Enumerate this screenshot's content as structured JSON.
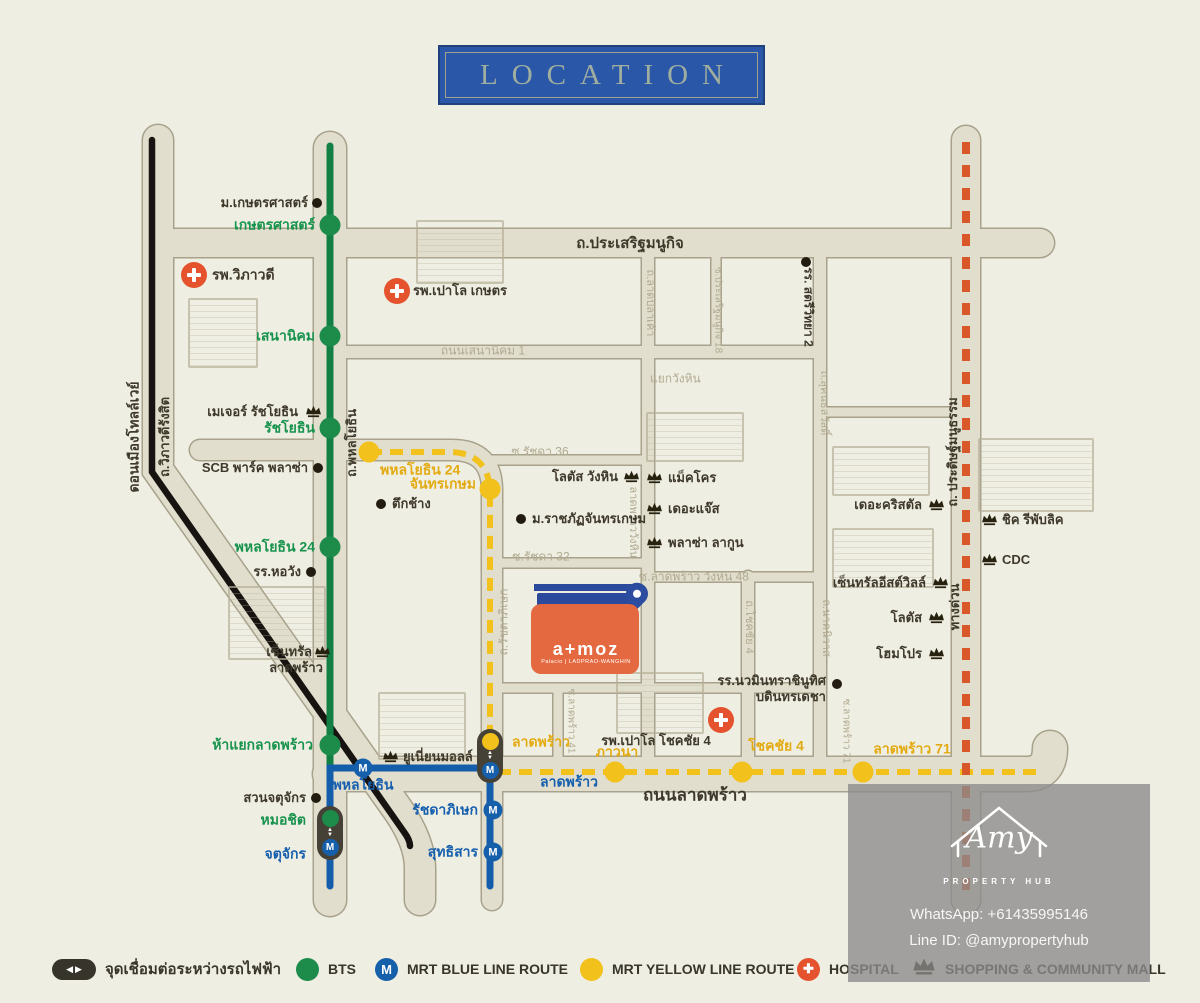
{
  "title": "LOCATION",
  "legend": {
    "items": [
      {
        "icon": "interchange-pill",
        "label": "จุดเชื่อมต่อระหว่างรถไฟฟ้า"
      },
      {
        "icon": "bts-circle",
        "label": "BTS"
      },
      {
        "icon": "mrt-blue-circle",
        "label": "MRT BLUE LINE ROUTE"
      },
      {
        "icon": "mrt-yellow-circle",
        "label": "MRT YELLOW LINE ROUTE"
      },
      {
        "icon": "hospital-cross",
        "label": "HOSPITAL"
      },
      {
        "icon": "crown",
        "label": "SHOPPING & COMMUNITY MALL"
      }
    ]
  },
  "watermark": {
    "brand": "Amy",
    "tagline": "PROPERTY HUB",
    "whatsapp": "WhatsApp: +61435995146",
    "line_id": "Line ID: @amypropertyhub"
  },
  "atmoz": {
    "brand": "a+moz",
    "sub": "Palacio | LADPRAO-WANGHIN"
  },
  "map": {
    "colors": {
      "background": "#efeee2",
      "road_fill": "#e1decd",
      "road_casing": "#a8a28c",
      "bts_green": "#1d8c4b",
      "mrt_blue": "#155fab",
      "mrt_yellow": "#f2c11b",
      "expressway_orange": "#d8582a",
      "tollway_black": "#171310",
      "hospital_red": "#e4532e",
      "title_blue": "#2b57a9"
    },
    "labels": [
      {
        "t": "ถ.ประเสริฐมนูกิจ",
        "x": 630,
        "y": 244,
        "a": "c",
        "s": 15
      },
      {
        "t": "ถนนลาดพร้าว",
        "x": 695,
        "y": 796,
        "a": "c",
        "s": 17
      },
      {
        "t": "ถนนเสนานิคม 1",
        "x": 483,
        "y": 351,
        "a": "c",
        "c": "be",
        "s": 12
      },
      {
        "t": "แยกวังหิน",
        "x": 650,
        "y": 379,
        "a": "l",
        "c": "be",
        "s": 12
      },
      {
        "t": "ซ.รัชดา 36",
        "x": 540,
        "y": 452,
        "a": "c",
        "c": "be",
        "s": 12
      },
      {
        "t": "ซ.รัชดา 32",
        "x": 541,
        "y": 557,
        "a": "c",
        "c": "be",
        "s": 12
      },
      {
        "t": "ซ.ลาดพร้าว วังหิน 48",
        "x": 694,
        "y": 577,
        "a": "c",
        "c": "be",
        "s": 12
      },
      {
        "t": "ดอนเมืองโทลล์เวย์",
        "x": 134,
        "y": 437,
        "a": "c",
        "r": -90,
        "s": 14
      },
      {
        "t": "ถ.วิภาวดีรังสิต",
        "x": 165,
        "y": 437,
        "a": "c",
        "r": -90,
        "s": 13
      },
      {
        "t": "ถ.พหลโยธิน",
        "x": 352,
        "y": 443,
        "a": "c",
        "r": -90,
        "s": 13
      },
      {
        "t": "ถ.ลาดปลาเค้า",
        "x": 650,
        "y": 303,
        "a": "c",
        "r": 90,
        "c": "be",
        "s": 11
      },
      {
        "t": "ซ.ประเสริฐมนูกิจ 18",
        "x": 718,
        "y": 310,
        "a": "c",
        "r": 90,
        "c": "be",
        "s": 10
      },
      {
        "t": "ถ.รัชดาภิเษก",
        "x": 504,
        "y": 622,
        "a": "c",
        "r": -90,
        "c": "be",
        "s": 12
      },
      {
        "t": "ถ. ลาดพร้าววังหิน",
        "x": 633,
        "y": 516,
        "a": "c",
        "r": 90,
        "c": "be",
        "s": 11
      },
      {
        "t": "ถ.โชคชัย 4",
        "x": 749,
        "y": 627,
        "a": "c",
        "r": 90,
        "c": "be",
        "s": 11
      },
      {
        "t": "ถ.นาคนิวาส",
        "x": 826,
        "y": 628,
        "a": "c",
        "r": 90,
        "c": "be",
        "s": 11
      },
      {
        "t": "ถ.สุคนธสวัสดิ์",
        "x": 824,
        "y": 403,
        "a": "c",
        "r": 90,
        "c": "be",
        "s": 11
      },
      {
        "t": "ซ.ลาดพร้าว 41",
        "x": 571,
        "y": 721,
        "a": "c",
        "r": 90,
        "c": "be",
        "s": 10
      },
      {
        "t": "ซ.ลาดพร้าว 71",
        "x": 846,
        "y": 731,
        "a": "c",
        "r": 90,
        "c": "be",
        "s": 10
      },
      {
        "t": "ถ. ประดิษฐ์มนูธรรม",
        "x": 953,
        "y": 452,
        "a": "c",
        "r": -90,
        "s": 13
      },
      {
        "t": "ทางด่วน",
        "x": 955,
        "y": 607,
        "a": "c",
        "r": -90,
        "s": 13
      },
      {
        "t": "เกษตรศาสตร์",
        "x": 315,
        "y": 225,
        "a": "r",
        "c": "g",
        "s": 14
      },
      {
        "t": "เสนานิคม",
        "x": 315,
        "y": 336,
        "a": "r",
        "c": "g",
        "s": 14
      },
      {
        "t": "รัชโยธิน",
        "x": 315,
        "y": 428,
        "a": "r",
        "c": "g",
        "s": 14
      },
      {
        "t": "พหลโยธิน 24",
        "x": 315,
        "y": 547,
        "a": "r",
        "c": "g",
        "s": 14
      },
      {
        "t": "ห้าแยกลาดพร้าว",
        "x": 313,
        "y": 745,
        "a": "r",
        "c": "g",
        "s": 14
      },
      {
        "t": "หมอชิต",
        "x": 306,
        "y": 820,
        "a": "r",
        "c": "g",
        "s": 14
      },
      {
        "t": "จตุจักร",
        "x": 306,
        "y": 854,
        "a": "r",
        "c": "bl",
        "s": 14
      },
      {
        "t": "พหลโยธิน",
        "x": 363,
        "y": 785,
        "a": "c",
        "c": "bl",
        "s": 14
      },
      {
        "t": "ลาดพร้าว",
        "x": 540,
        "y": 782,
        "a": "l",
        "c": "bl",
        "s": 14
      },
      {
        "t": "รัชดาภิเษก",
        "x": 478,
        "y": 810,
        "a": "r",
        "c": "bl",
        "s": 14
      },
      {
        "t": "สุทธิสาร",
        "x": 478,
        "y": 852,
        "a": "r",
        "c": "bl",
        "s": 14
      },
      {
        "t": "พหลโยธิน 24",
        "x": 380,
        "y": 470,
        "a": "l",
        "c": "y",
        "s": 14
      },
      {
        "t": "จันทรเกษม",
        "x": 476,
        "y": 484,
        "a": "r",
        "c": "y",
        "s": 14
      },
      {
        "t": "ลาดพร้าว",
        "x": 512,
        "y": 742,
        "a": "l",
        "c": "y",
        "s": 14
      },
      {
        "t": "ภาวนา",
        "x": 617,
        "y": 752,
        "a": "c",
        "c": "y",
        "s": 14
      },
      {
        "t": "โชคชัย 4",
        "x": 776,
        "y": 746,
        "a": "c",
        "c": "y",
        "s": 14
      },
      {
        "t": "ลาดพร้าว 71",
        "x": 912,
        "y": 749,
        "a": "c",
        "c": "y",
        "s": 14
      },
      {
        "t": "ม.เกษตรศาสตร์",
        "x": 308,
        "y": 203,
        "a": "r"
      },
      {
        "t": "รพ.วิภาวดี",
        "x": 212,
        "y": 275,
        "a": "l",
        "s": 14
      },
      {
        "t": "SCB พาร์ค พลาซ่า",
        "x": 308,
        "y": 468,
        "a": "r"
      },
      {
        "t": "ตึกช้าง",
        "x": 392,
        "y": 504,
        "a": "l"
      },
      {
        "t": "รร.หอวัง",
        "x": 301,
        "y": 572,
        "a": "r"
      },
      {
        "t": "เมเจอร์ รัชโยธิน",
        "x": 298,
        "y": 412,
        "a": "r"
      },
      {
        "t": "สวนจตุจักร",
        "x": 306,
        "y": 798,
        "a": "r"
      },
      {
        "t": "เซ็นทรัล",
        "x": 312,
        "y": 652,
        "a": "r"
      },
      {
        "t": "ลาดพร้าว",
        "x": 296,
        "y": 668,
        "a": "c"
      },
      {
        "t": "ยูเนี่ยนมอลล์",
        "x": 403,
        "y": 757,
        "a": "l"
      },
      {
        "t": "โลตัส วังหิน",
        "x": 618,
        "y": 477,
        "a": "r"
      },
      {
        "t": "แม็คโคร",
        "x": 668,
        "y": 478,
        "a": "l"
      },
      {
        "t": "เดอะแจ๊ส",
        "x": 668,
        "y": 509,
        "a": "l"
      },
      {
        "t": "พลาซ่า ลากูน",
        "x": 668,
        "y": 543,
        "a": "l"
      },
      {
        "t": "ม.ราชภัฏจันทรเกษม",
        "x": 532,
        "y": 519,
        "a": "l"
      },
      {
        "t": "รพ.เปาโล เกษตร",
        "x": 413,
        "y": 291,
        "a": "l"
      },
      {
        "t": "รพ.เปาโล โชคชัย 4",
        "x": 656,
        "y": 741,
        "a": "c"
      },
      {
        "t": "รร.นวมินทราชินูทิศ",
        "x": 826,
        "y": 681,
        "a": "r"
      },
      {
        "t": "บดินทรเดชา",
        "x": 826,
        "y": 697,
        "a": "r"
      },
      {
        "t": "รร. สตรีวิทยา 2",
        "x": 808,
        "y": 307,
        "a": "c",
        "r": 90,
        "s": 12
      },
      {
        "t": "เดอะคริสตัล",
        "x": 922,
        "y": 505,
        "a": "r"
      },
      {
        "t": "เซ็นทรัลอีสต์วิลล์",
        "x": 926,
        "y": 583,
        "a": "r"
      },
      {
        "t": "โลตัส",
        "x": 922,
        "y": 618,
        "a": "r"
      },
      {
        "t": "โฮมโปร",
        "x": 922,
        "y": 654,
        "a": "r"
      },
      {
        "t": "ชิค รีพับลิค",
        "x": 1002,
        "y": 520,
        "a": "l"
      },
      {
        "t": "CDC",
        "x": 1002,
        "y": 560,
        "a": "l"
      }
    ],
    "icons": [
      {
        "type": "bts",
        "name": "bts-station-kasetsart",
        "x": 330,
        "y": 225
      },
      {
        "type": "bts",
        "name": "bts-station-senanikhom",
        "x": 330,
        "y": 336
      },
      {
        "type": "bts",
        "name": "bts-station-ratchayothin",
        "x": 330,
        "y": 428
      },
      {
        "type": "bts",
        "name": "bts-station-phahonyothin24",
        "x": 330,
        "y": 547
      },
      {
        "type": "bts",
        "name": "bts-station-hayaeklatphrao",
        "x": 330,
        "y": 745
      },
      {
        "type": "yellow",
        "name": "mrt-yellow-station-phahonyothin24",
        "x": 369,
        "y": 452
      },
      {
        "type": "yellow",
        "name": "mrt-yellow-station-chankasem",
        "x": 490,
        "y": 489
      },
      {
        "type": "yellow",
        "name": "mrt-yellow-station-phawana",
        "x": 615,
        "y": 772
      },
      {
        "type": "yellow",
        "name": "mrt-yellow-station-chokchai4",
        "x": 742,
        "y": 772
      },
      {
        "type": "yellow",
        "name": "mrt-yellow-station-latphrao71",
        "x": 863,
        "y": 772
      },
      {
        "type": "mrt",
        "name": "mrt-station-phahonyothin",
        "x": 363,
        "y": 768
      },
      {
        "type": "mrt",
        "name": "mrt-station-ratchadaphisek",
        "x": 493,
        "y": 810
      },
      {
        "type": "mrt",
        "name": "mrt-station-sutthisan",
        "x": 493,
        "y": 852
      },
      {
        "type": "pill",
        "top": "bts",
        "name": "interchange-mochit-chatuchak",
        "x": 330,
        "y": 833
      },
      {
        "type": "pill",
        "top": "yellow",
        "name": "interchange-latphrao",
        "x": 490,
        "y": 756
      },
      {
        "type": "dot",
        "name": "poi-kasetsart-university",
        "x": 317,
        "y": 203
      },
      {
        "type": "dot",
        "name": "poi-scb-park-plaza",
        "x": 318,
        "y": 468
      },
      {
        "type": "dot",
        "name": "poi-elephant-tower",
        "x": 381,
        "y": 504
      },
      {
        "type": "dot",
        "name": "poi-horwang-school",
        "x": 311,
        "y": 572
      },
      {
        "type": "dot",
        "name": "poi-chatuchak-park",
        "x": 316,
        "y": 798
      },
      {
        "type": "dot",
        "name": "poi-chandrakasem-university",
        "x": 521,
        "y": 519
      },
      {
        "type": "dot",
        "name": "poi-bodindecha-school",
        "x": 837,
        "y": 684
      },
      {
        "type": "dot",
        "name": "poi-satriwitthaya2-school",
        "x": 806,
        "y": 262
      },
      {
        "type": "hospital",
        "name": "hospital-vibhavadi",
        "x": 194,
        "y": 275
      },
      {
        "type": "hospital",
        "name": "hospital-paolo-kaset",
        "x": 397,
        "y": 291
      },
      {
        "type": "hospital",
        "name": "hospital-paolo-chokchai4",
        "x": 721,
        "y": 720
      },
      {
        "type": "crown",
        "name": "mall-major-ratchayothin",
        "x": 313,
        "y": 411
      },
      {
        "type": "crown",
        "name": "mall-central-ladprao",
        "x": 322,
        "y": 651
      },
      {
        "type": "crown",
        "name": "mall-union-mall",
        "x": 390,
        "y": 756
      },
      {
        "type": "crown",
        "name": "mall-lotus-wanghin",
        "x": 631,
        "y": 476
      },
      {
        "type": "crown",
        "name": "mall-makro",
        "x": 654,
        "y": 477
      },
      {
        "type": "crown",
        "name": "mall-the-jas",
        "x": 654,
        "y": 508
      },
      {
        "type": "crown",
        "name": "mall-plaza-lagoon",
        "x": 654,
        "y": 542
      },
      {
        "type": "crown",
        "name": "mall-the-crystal",
        "x": 936,
        "y": 504
      },
      {
        "type": "crown",
        "name": "mall-central-eastville",
        "x": 940,
        "y": 582
      },
      {
        "type": "crown",
        "name": "mall-lotus",
        "x": 936,
        "y": 617
      },
      {
        "type": "crown",
        "name": "mall-homepro",
        "x": 936,
        "y": 653
      },
      {
        "type": "crown",
        "name": "mall-chic-republic",
        "x": 989,
        "y": 519
      },
      {
        "type": "crown",
        "name": "mall-cdc",
        "x": 989,
        "y": 559
      },
      {
        "type": "pin",
        "name": "atmoz-location-pin",
        "x": 637,
        "y": 603
      }
    ],
    "buildings": [
      {
        "name": "vibhavadi-hospital-building",
        "x": 188,
        "y": 298,
        "w": 66,
        "h": 66
      },
      {
        "name": "paolo-kaset-building",
        "x": 416,
        "y": 220,
        "w": 84,
        "h": 60
      },
      {
        "name": "central-ladprao-building",
        "x": 228,
        "y": 586,
        "w": 94,
        "h": 70
      },
      {
        "name": "union-mall-building",
        "x": 378,
        "y": 692,
        "w": 84,
        "h": 64
      },
      {
        "name": "makro-building",
        "x": 646,
        "y": 412,
        "w": 94,
        "h": 46
      },
      {
        "name": "paolo-chokchai-building",
        "x": 616,
        "y": 672,
        "w": 84,
        "h": 58
      },
      {
        "name": "crystal-building",
        "x": 832,
        "y": 446,
        "w": 94,
        "h": 46
      },
      {
        "name": "eastville-building",
        "x": 832,
        "y": 528,
        "w": 98,
        "h": 56
      },
      {
        "name": "mansion-building",
        "x": 978,
        "y": 438,
        "w": 112,
        "h": 70
      }
    ]
  }
}
